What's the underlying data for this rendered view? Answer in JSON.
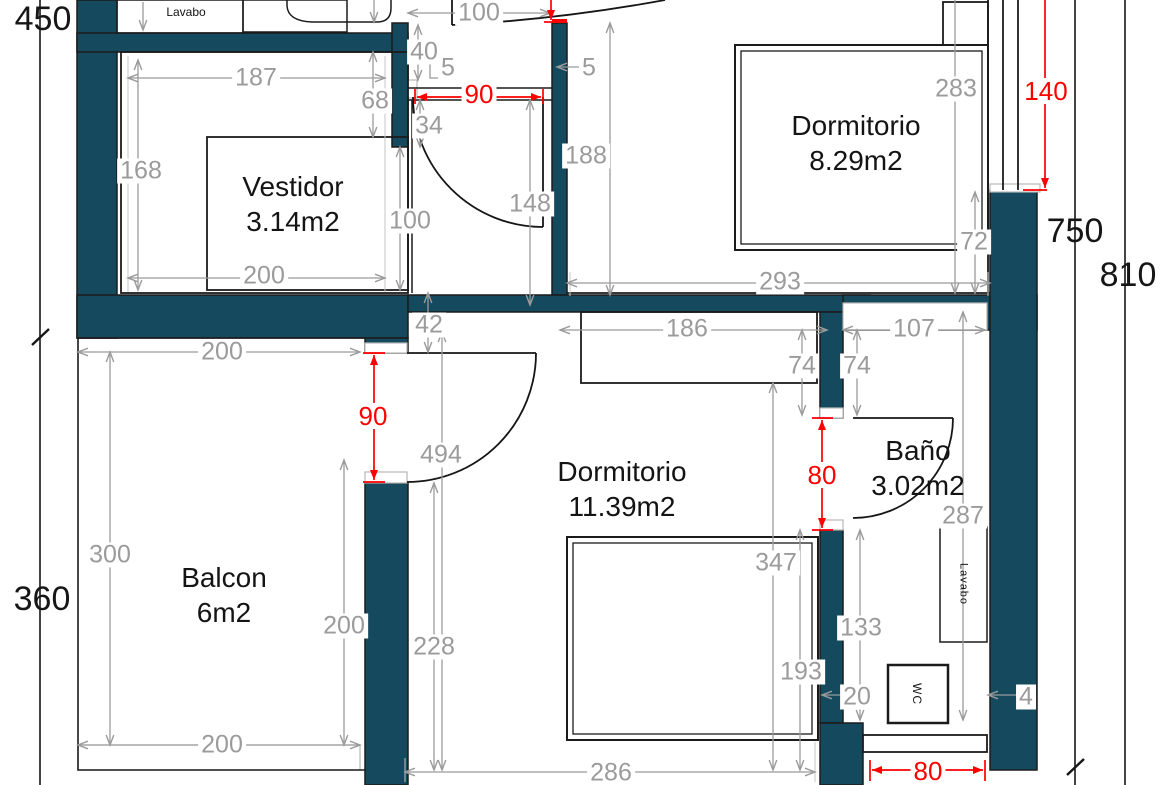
{
  "meta": {
    "type": "architectural-floor-plan",
    "language": "Spanish"
  },
  "colors": {
    "wall_fill": "#154A5E",
    "dimension_gray": "#9B9B9B",
    "dimension_red": "#FE0000",
    "line_black": "#1A1A1A",
    "background": "#FFFFFF"
  },
  "rooms": [
    {
      "key": "vestidor",
      "name": "Vestidor",
      "area": "3.14m2"
    },
    {
      "key": "dormitorio_8",
      "name": "Dormitorio",
      "area": "8.29m2"
    },
    {
      "key": "balcon",
      "name": "Balcon",
      "area": "6m2"
    },
    {
      "key": "dormitorio_11",
      "name": "Dormitorio",
      "area": "11.39m2"
    },
    {
      "key": "bano",
      "name": "Baño",
      "area": "3.02m2"
    }
  ],
  "fixtures": {
    "lavabo_top": "Lavabo",
    "lavabo_bano": "Lavabo",
    "wc": "WC"
  },
  "overall_dims": {
    "left_upper": "450",
    "left_lower": "360",
    "right_inner": "750",
    "right_outer": "810"
  },
  "red_dims": {
    "hall_door_width": "90",
    "balcony_door_height": "90",
    "right_window_height": "140",
    "bath_door_height": "80",
    "bath_window_width": "80"
  },
  "gray_dims": {
    "hall_top_width": "100",
    "hall_niche_depth": "40",
    "niche_offset_a": "5",
    "niche_offset_b": "5",
    "hall_offset_34": "34",
    "hall_wall_height": "188",
    "hall_door_offset": "148",
    "vestidor_opening": "100",
    "vestidor_width": "187",
    "vestidor_offset_68": "68",
    "vestidor_height": "168",
    "vestidor_bottom_width": "200",
    "dorm8_bed_height": "283",
    "dorm8_offset_72": "72",
    "dorm8_width": "293",
    "wall_offset_42": "42",
    "wardrobe_width": "186",
    "pass_offset_74_left": "74",
    "pass_offset_74_right": "74",
    "bath_top_width": "107",
    "door_clear_494": "494",
    "balcony_height": "300",
    "balcony_top_width": "200",
    "balcony_bottom_width": "200",
    "balcony_inner_height": "200",
    "dorm11_offset_347": "347",
    "bath_height_287": "287",
    "bath_offset_133": "133",
    "dorm11_offset_228": "228",
    "dorm11_offset_193": "193",
    "wc_offset_20": "20",
    "lavabo_offset_4": "4",
    "dorm11_bottom_width": "286"
  }
}
